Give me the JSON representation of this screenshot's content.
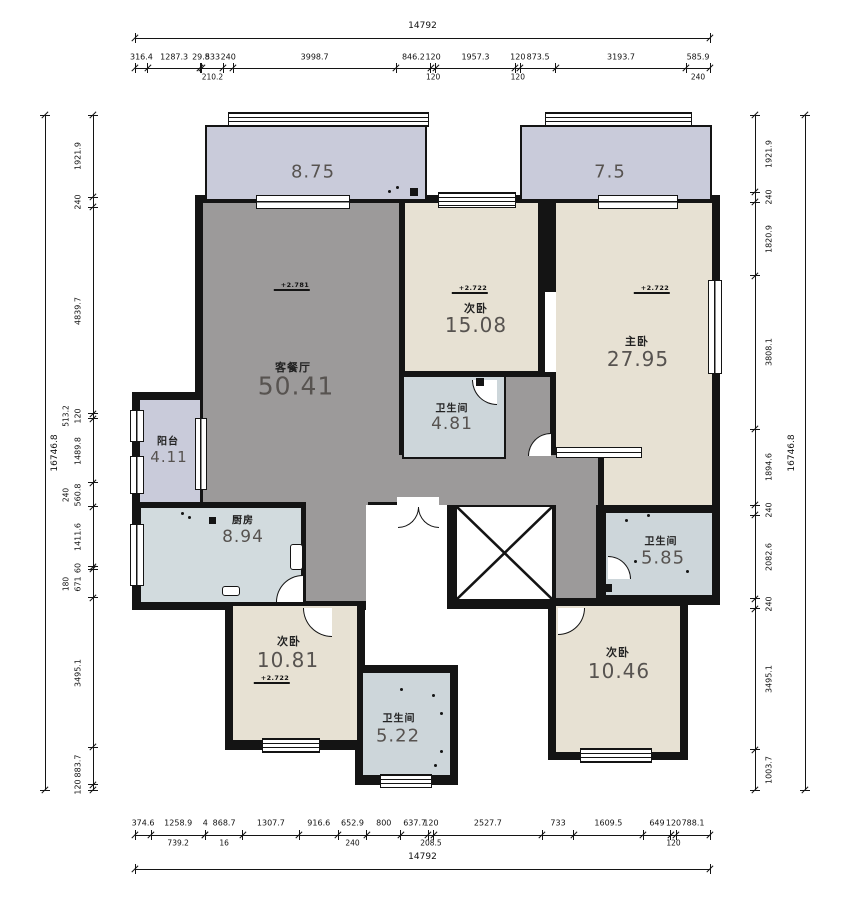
{
  "title": "户型图 floor plan",
  "colors": {
    "wall": "#141414",
    "balcony": "#c9cbda",
    "living": "#9c9a9a",
    "bedroom": "#e7e1d3",
    "bathroom": "#cdd6da",
    "kitchen": "#d2dbde"
  },
  "rooms": {
    "balcony_top_left": {
      "area": "8.75"
    },
    "balcony_top_right": {
      "area": "7.5"
    },
    "living": {
      "name": "客餐厅",
      "area": "50.41",
      "elevation": "+2.781"
    },
    "bedroom_top": {
      "name": "次卧",
      "area": "15.08",
      "elevation": "+2.722"
    },
    "master": {
      "name": "主卧",
      "area": "27.95",
      "elevation": "+2.722"
    },
    "bath_mid": {
      "name": "卫生间",
      "area": "4.81"
    },
    "balcony_west": {
      "name": "阳台",
      "area": "4.11"
    },
    "kitchen": {
      "name": "厨房",
      "area": "8.94"
    },
    "bedroom_bl": {
      "name": "次卧",
      "area": "10.81",
      "elevation": "+2.722"
    },
    "bath_bottom": {
      "name": "卫生间",
      "area": "5.22"
    },
    "bedroom_br": {
      "name": "次卧",
      "area": "10.46"
    },
    "bath_east": {
      "name": "卫生间",
      "area": "5.85"
    }
  },
  "dimensions": {
    "top": {
      "total": "14792",
      "segments": [
        "316.4",
        "1287.3",
        "29.8",
        "533",
        "240",
        "3998.7",
        "846.2",
        "120",
        "1957.3",
        "120",
        "873.5",
        "3193.7",
        "585.9"
      ],
      "subs": [
        {
          "text": "210.2",
          "seg": 3
        },
        {
          "text": "120",
          "seg": 7
        },
        {
          "text": "120",
          "seg": 9
        },
        {
          "text": "240",
          "seg": 12
        }
      ]
    },
    "bottom": {
      "total": "14792",
      "segments": [
        "374.6",
        "1258.9",
        "4",
        "868.7",
        "1307.7",
        "916.6",
        "652.9",
        "800",
        "637.7",
        "120",
        "2527.7",
        "733",
        "1609.5",
        "649",
        "120",
        "788.1"
      ],
      "subs": [
        {
          "text": "739.2",
          "seg": 1
        },
        {
          "text": "16",
          "seg": 3
        },
        {
          "text": "240",
          "seg": 6
        },
        {
          "text": "208.5",
          "seg": 9
        },
        {
          "text": "120",
          "seg": 14
        }
      ]
    },
    "left": {
      "total": "16746.8",
      "segments": [
        "1921.9",
        "240",
        "4839.7",
        "120",
        "1489.8",
        "560.8",
        "1411.6",
        "60",
        "671",
        "3495.1",
        "883.7",
        "120"
      ],
      "subs": [
        {
          "text": "513.2",
          "seg": 3
        },
        {
          "text": "240",
          "seg": 5
        },
        {
          "text": "180",
          "seg": 8
        }
      ]
    },
    "right": {
      "total": "16746.8",
      "segments": [
        "1921.9",
        "240",
        "1820.9",
        "3808.1",
        "1894.6",
        "240",
        "2082.6",
        "240",
        "3495.1",
        "1003.7"
      ],
      "subs": []
    }
  }
}
